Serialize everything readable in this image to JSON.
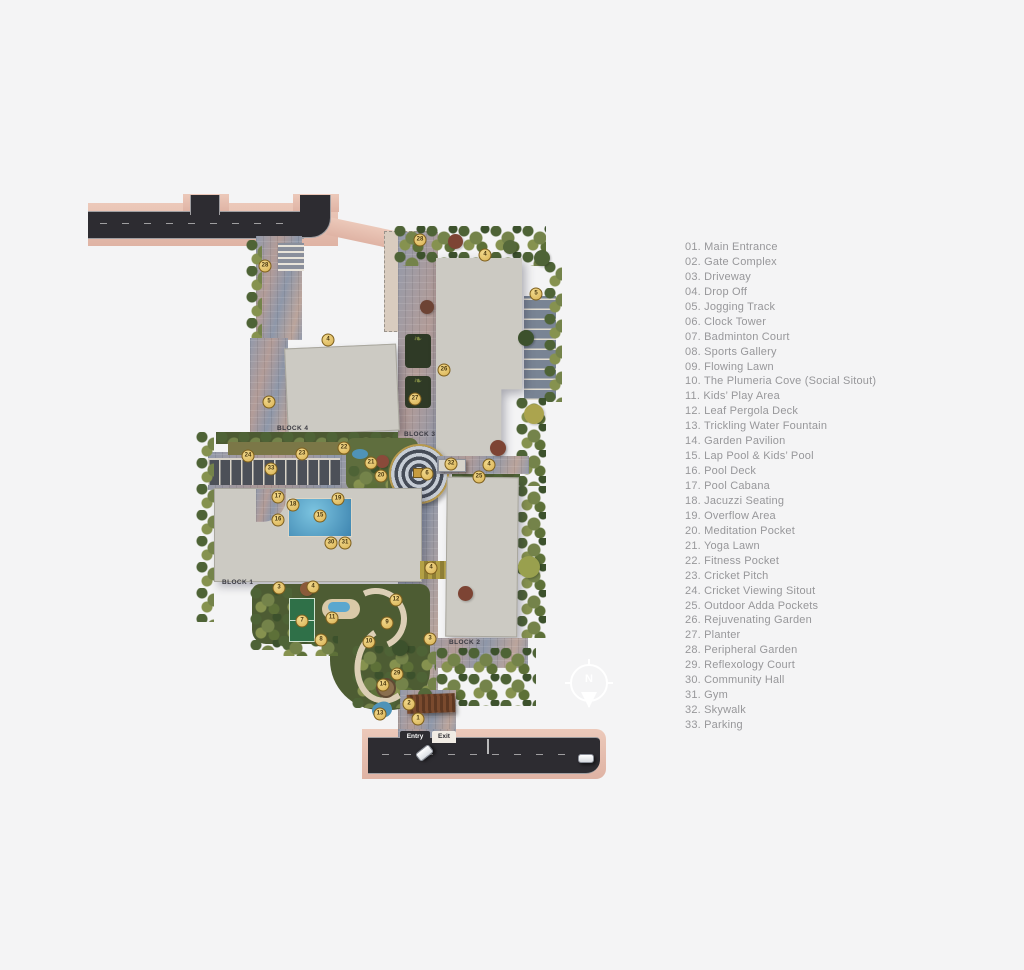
{
  "canvas": {
    "background": "#f4f4f5"
  },
  "colors": {
    "marker_gold": "#E3BD5E",
    "road_dark": "#2D2C31",
    "sidewalk_salmon": "#E6C2B4",
    "building_gray": "#CCCAC3",
    "pool_blue": "#4C93BD",
    "greenery": "#5C6C3D",
    "clubhouse_beige": "#D9CCBF"
  },
  "map": {
    "clubhouse": {
      "line1": "PROPOSED",
      "line2": "CLUBHOUSE"
    },
    "blocks": {
      "block1": "BLOCK 1",
      "block2": "BLOCK 2",
      "block3": "BLOCK 3",
      "block4": "BLOCK 4"
    },
    "gate": {
      "entry": "Entry",
      "exit": "Exit"
    },
    "compass": {
      "north": "N"
    },
    "markers": [
      {
        "n": "28",
        "x": 420,
        "y": 240
      },
      {
        "n": "4",
        "x": 485,
        "y": 255
      },
      {
        "n": "28",
        "x": 265,
        "y": 266
      },
      {
        "n": "5",
        "x": 536,
        "y": 294
      },
      {
        "n": "4",
        "x": 328,
        "y": 340
      },
      {
        "n": "26",
        "x": 444,
        "y": 370
      },
      {
        "n": "27",
        "x": 415,
        "y": 399
      },
      {
        "n": "5",
        "x": 269,
        "y": 402
      },
      {
        "n": "22",
        "x": 344,
        "y": 448
      },
      {
        "n": "23",
        "x": 302,
        "y": 454
      },
      {
        "n": "24",
        "x": 248,
        "y": 456
      },
      {
        "n": "21",
        "x": 371,
        "y": 463
      },
      {
        "n": "32",
        "x": 451,
        "y": 464
      },
      {
        "n": "4",
        "x": 489,
        "y": 465
      },
      {
        "n": "33",
        "x": 271,
        "y": 469
      },
      {
        "n": "6",
        "x": 427,
        "y": 474
      },
      {
        "n": "20",
        "x": 381,
        "y": 476
      },
      {
        "n": "25",
        "x": 479,
        "y": 477
      },
      {
        "n": "17",
        "x": 278,
        "y": 497
      },
      {
        "n": "19",
        "x": 338,
        "y": 499
      },
      {
        "n": "18",
        "x": 293,
        "y": 505
      },
      {
        "n": "15",
        "x": 320,
        "y": 516
      },
      {
        "n": "16",
        "x": 278,
        "y": 520
      },
      {
        "n": "30",
        "x": 331,
        "y": 543
      },
      {
        "n": "31",
        "x": 345,
        "y": 543
      },
      {
        "n": "4",
        "x": 431,
        "y": 568
      },
      {
        "n": "3",
        "x": 279,
        "y": 588
      },
      {
        "n": "4",
        "x": 313,
        "y": 587
      },
      {
        "n": "12",
        "x": 396,
        "y": 600
      },
      {
        "n": "11",
        "x": 332,
        "y": 618
      },
      {
        "n": "7",
        "x": 302,
        "y": 621
      },
      {
        "n": "9",
        "x": 387,
        "y": 623
      },
      {
        "n": "3",
        "x": 430,
        "y": 639
      },
      {
        "n": "8",
        "x": 321,
        "y": 640
      },
      {
        "n": "10",
        "x": 369,
        "y": 642
      },
      {
        "n": "29",
        "x": 397,
        "y": 674
      },
      {
        "n": "14",
        "x": 383,
        "y": 685
      },
      {
        "n": "2",
        "x": 409,
        "y": 704
      },
      {
        "n": "13",
        "x": 380,
        "y": 714
      },
      {
        "n": "1",
        "x": 418,
        "y": 719
      }
    ]
  },
  "legend": {
    "items": [
      {
        "text": "01. Main Entrance"
      },
      {
        "text": "02. Gate Complex"
      },
      {
        "text": "03. Driveway"
      },
      {
        "text": "04. Drop Off"
      },
      {
        "text": "05. Jogging Track"
      },
      {
        "text": "06. Clock Tower"
      },
      {
        "text": "07. Badminton Court"
      },
      {
        "text": "08. Sports Gallery"
      },
      {
        "text": "09. Flowing Lawn"
      },
      {
        "text": "10. The Plumeria Cove (Social Sitout)"
      },
      {
        "text": "11. Kids’ Play Area"
      },
      {
        "text": "12. Leaf Pergola Deck"
      },
      {
        "text": "13. Trickling Water Fountain"
      },
      {
        "text": "14. Garden Pavilion"
      },
      {
        "text": "15. Lap Pool & Kids’ Pool"
      },
      {
        "text": "16. Pool Deck"
      },
      {
        "text": "17. Pool Cabana"
      },
      {
        "text": "18. Jacuzzi Seating"
      },
      {
        "text": "19. Overflow Area"
      },
      {
        "text": "20. Meditation Pocket"
      },
      {
        "text": "21. Yoga Lawn"
      },
      {
        "text": "22. Fitness Pocket"
      },
      {
        "text": "23. Cricket Pitch"
      },
      {
        "text": "24. Cricket Viewing Sitout"
      },
      {
        "text": "25. Outdoor Adda Pockets"
      },
      {
        "text": "26. Rejuvenating Garden"
      },
      {
        "text": "27. Planter"
      },
      {
        "text": "28. Peripheral Garden"
      },
      {
        "text": "29. Reflexology Court"
      },
      {
        "text": "30. Community Hall"
      },
      {
        "text": "31. Gym"
      },
      {
        "text": "32. Skywalk"
      },
      {
        "text": "33. Parking"
      }
    ]
  }
}
